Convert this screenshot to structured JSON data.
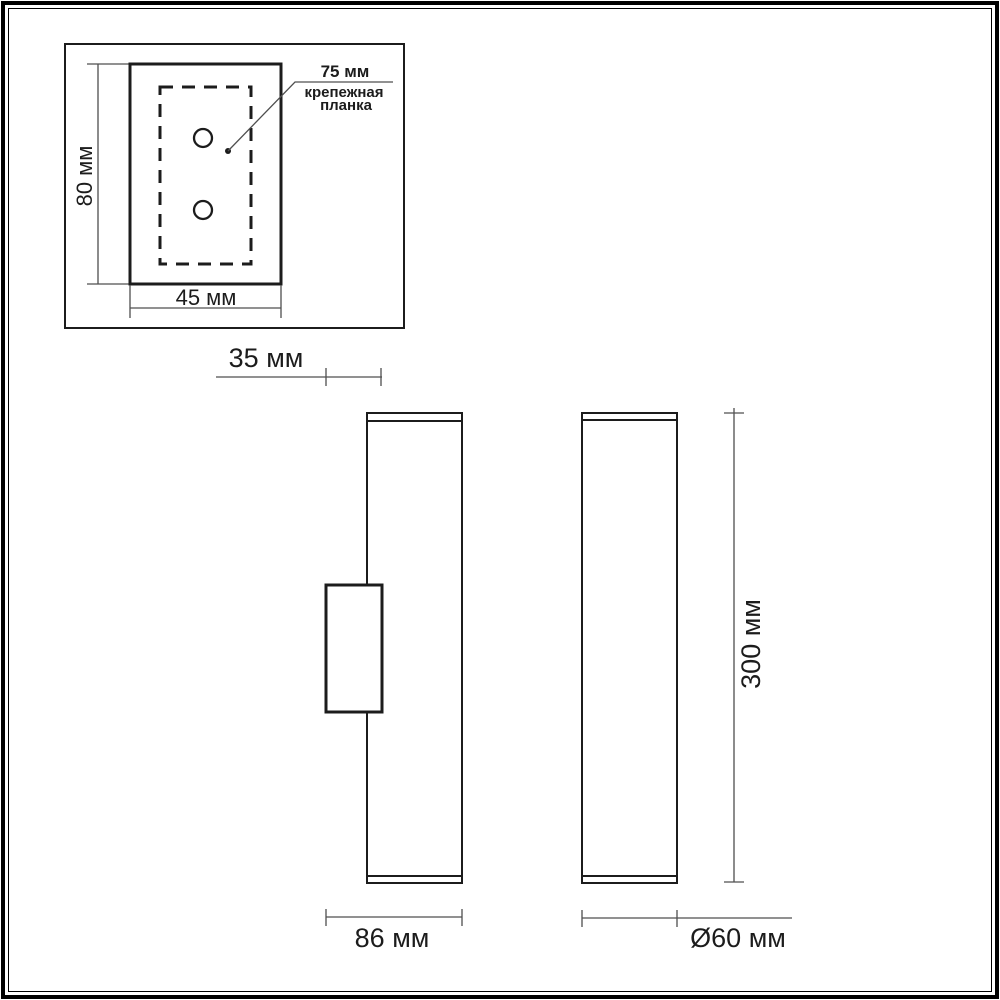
{
  "page": {
    "background": "#ffffff",
    "outline_color": "#1c1c1c",
    "dimension_line_color": "#4f4f4f",
    "unit": "мм"
  },
  "mounting_plate_inset": {
    "description": "top view of wall mounting plate with two screw holes",
    "height_dim": "80 мм",
    "width_dim": "45 мм",
    "callout_dim": "75 мм",
    "callout_line1": "крепежная",
    "callout_line2": "планка",
    "holes_count": 2
  },
  "side_view": {
    "description": "lamp side profile with mounting bracket",
    "bracket_depth_dim": "35 мм",
    "overall_depth_dim": "86 мм"
  },
  "front_view": {
    "description": "lamp front profile",
    "height_dim": "300 мм",
    "diameter_dim": "Ø60 мм"
  }
}
